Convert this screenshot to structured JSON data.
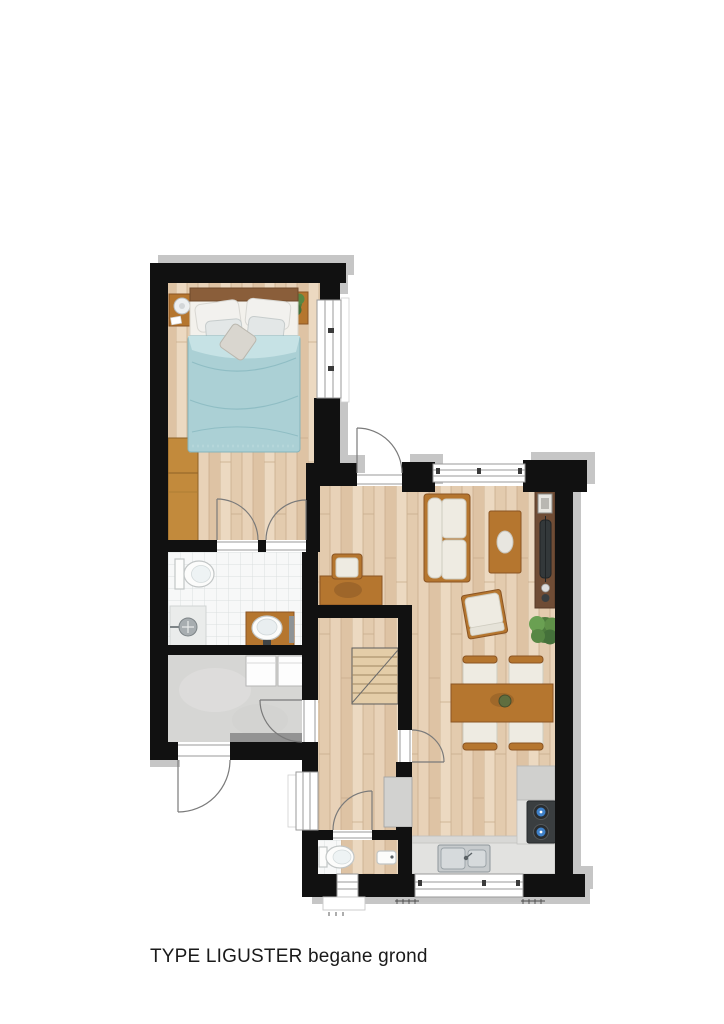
{
  "page": {
    "width": 724,
    "height": 1024,
    "background": "#ffffff"
  },
  "caption": {
    "text": "TYPE LIGUSTER begane grond"
  },
  "colors": {
    "wall": "#111111",
    "shadow": "#c6c6c6",
    "text": "#1a1a1a",
    "page": "#ffffff",
    "wood-a": "#ecd9c1",
    "wood-b": "#e3cbae",
    "wood-c": "#e8d2b8",
    "wood-d": "#dec3a4",
    "wood-line": "#c9ad8e",
    "tile": "#f7f8f8",
    "tile-line": "#dbdfdf",
    "concrete": "#d6d6d4",
    "furn-wood": "#b5762f",
    "furn-wood-dark": "#8a5423",
    "walnut": "#6f4c35",
    "cushion": "#eeebe2",
    "cushion-line": "#cfccc0",
    "duvet": "#abd0d5",
    "duvet-dark": "#8fbdc4",
    "duvet-light": "#c6e2e5",
    "plant": "#4e7c3e",
    "plant-light": "#6aa052",
    "counter": "#e2e2e0",
    "kitchen-floor": "#d8d8d6",
    "appliance": "#d0d0ce",
    "cooktop": "#3a3e40",
    "burner-blue": "#3e80c8",
    "steel": "#c7cbcd",
    "fixture": "#fcfcfb",
    "fixture-line": "#c2c6c6",
    "door": "#7a7a7a",
    "window-frame": "#9a9a9a",
    "stair": "#e4cda8",
    "stair-line": "#a08662"
  },
  "plan": {
    "type": "floorplan",
    "rooms": [
      {
        "id": "bedroom",
        "floor": "wood",
        "furniture": [
          "double-bed",
          "nightstand-left",
          "nightstand-right",
          "table-lamp",
          "plant",
          "wardrobe"
        ]
      },
      {
        "id": "bathroom",
        "floor": "tile",
        "furniture": [
          "toilet",
          "shower",
          "washbasin-vanity"
        ]
      },
      {
        "id": "storage",
        "floor": "concrete",
        "furniture": [
          "washer",
          "dryer"
        ]
      },
      {
        "id": "hall",
        "floor": "wood",
        "furniture": [
          "staircase",
          "desk",
          "desk-chair",
          "understairs-closet"
        ]
      },
      {
        "id": "toilet-room",
        "floor": "tile",
        "furniture": [
          "toilet",
          "hand-basin"
        ]
      },
      {
        "id": "living-room",
        "floor": "wood",
        "furniture": [
          "sofa",
          "coffee-table",
          "armchair",
          "tv-cabinet",
          "plant",
          "dining-table",
          "dining-chairs-x4"
        ]
      },
      {
        "id": "kitchen",
        "floor": "wood",
        "furniture": [
          "counter",
          "sink",
          "cooktop",
          "appliance-block"
        ]
      }
    ],
    "openings": {
      "windows": [
        "bedroom-right",
        "living-top",
        "hall-left",
        "toilet-bottom",
        "kitchen-bottom"
      ],
      "doors": [
        "front-door",
        "back-door",
        "bedroom-door",
        "bathroom-door",
        "storage-door",
        "toilet-door",
        "living-door"
      ]
    }
  }
}
